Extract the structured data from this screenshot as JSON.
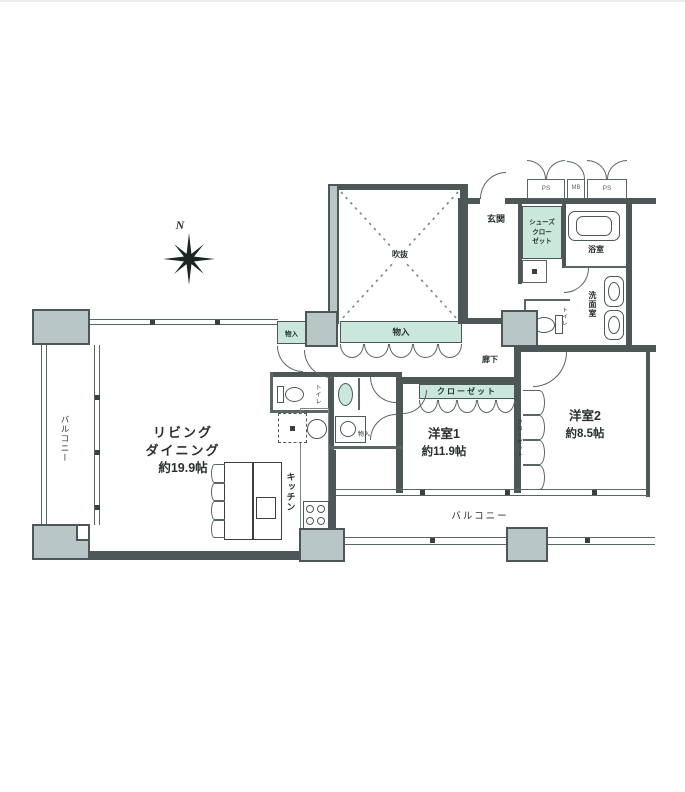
{
  "plan": {
    "compass": "N",
    "living_dining": {
      "l1": "リビング",
      "l2": "ダイニング",
      "size": "約19.9帖"
    },
    "kitchen": "キッチン",
    "bedroom1": {
      "name": "洋室1",
      "size": "約11.9帖",
      "closet": "クローゼット"
    },
    "bedroom2": {
      "name": "洋室2",
      "size": "約8.5帖",
      "closet": "クローゼット"
    },
    "entrance": "玄関",
    "hallway": "廊下",
    "bathroom": "浴室",
    "washroom": "洗面室",
    "toilet1": "トイレ",
    "toilet2": "トイレ",
    "shoes_closet": {
      "l1": "シューズ",
      "l2": "クロー",
      "l3": "ゼット"
    },
    "storage_main": "物入",
    "storage_small": "物入",
    "storage_tiny": "物入",
    "void": "吹抜",
    "balcony_left": "バルコニー",
    "balcony_bottom": "バルコニー",
    "utility_boxes": [
      "PS",
      "MB",
      "PS"
    ],
    "colors": {
      "wall": "#4d5757",
      "pillar": "#b9c6c6",
      "accent_green": "#c9e7da"
    }
  }
}
